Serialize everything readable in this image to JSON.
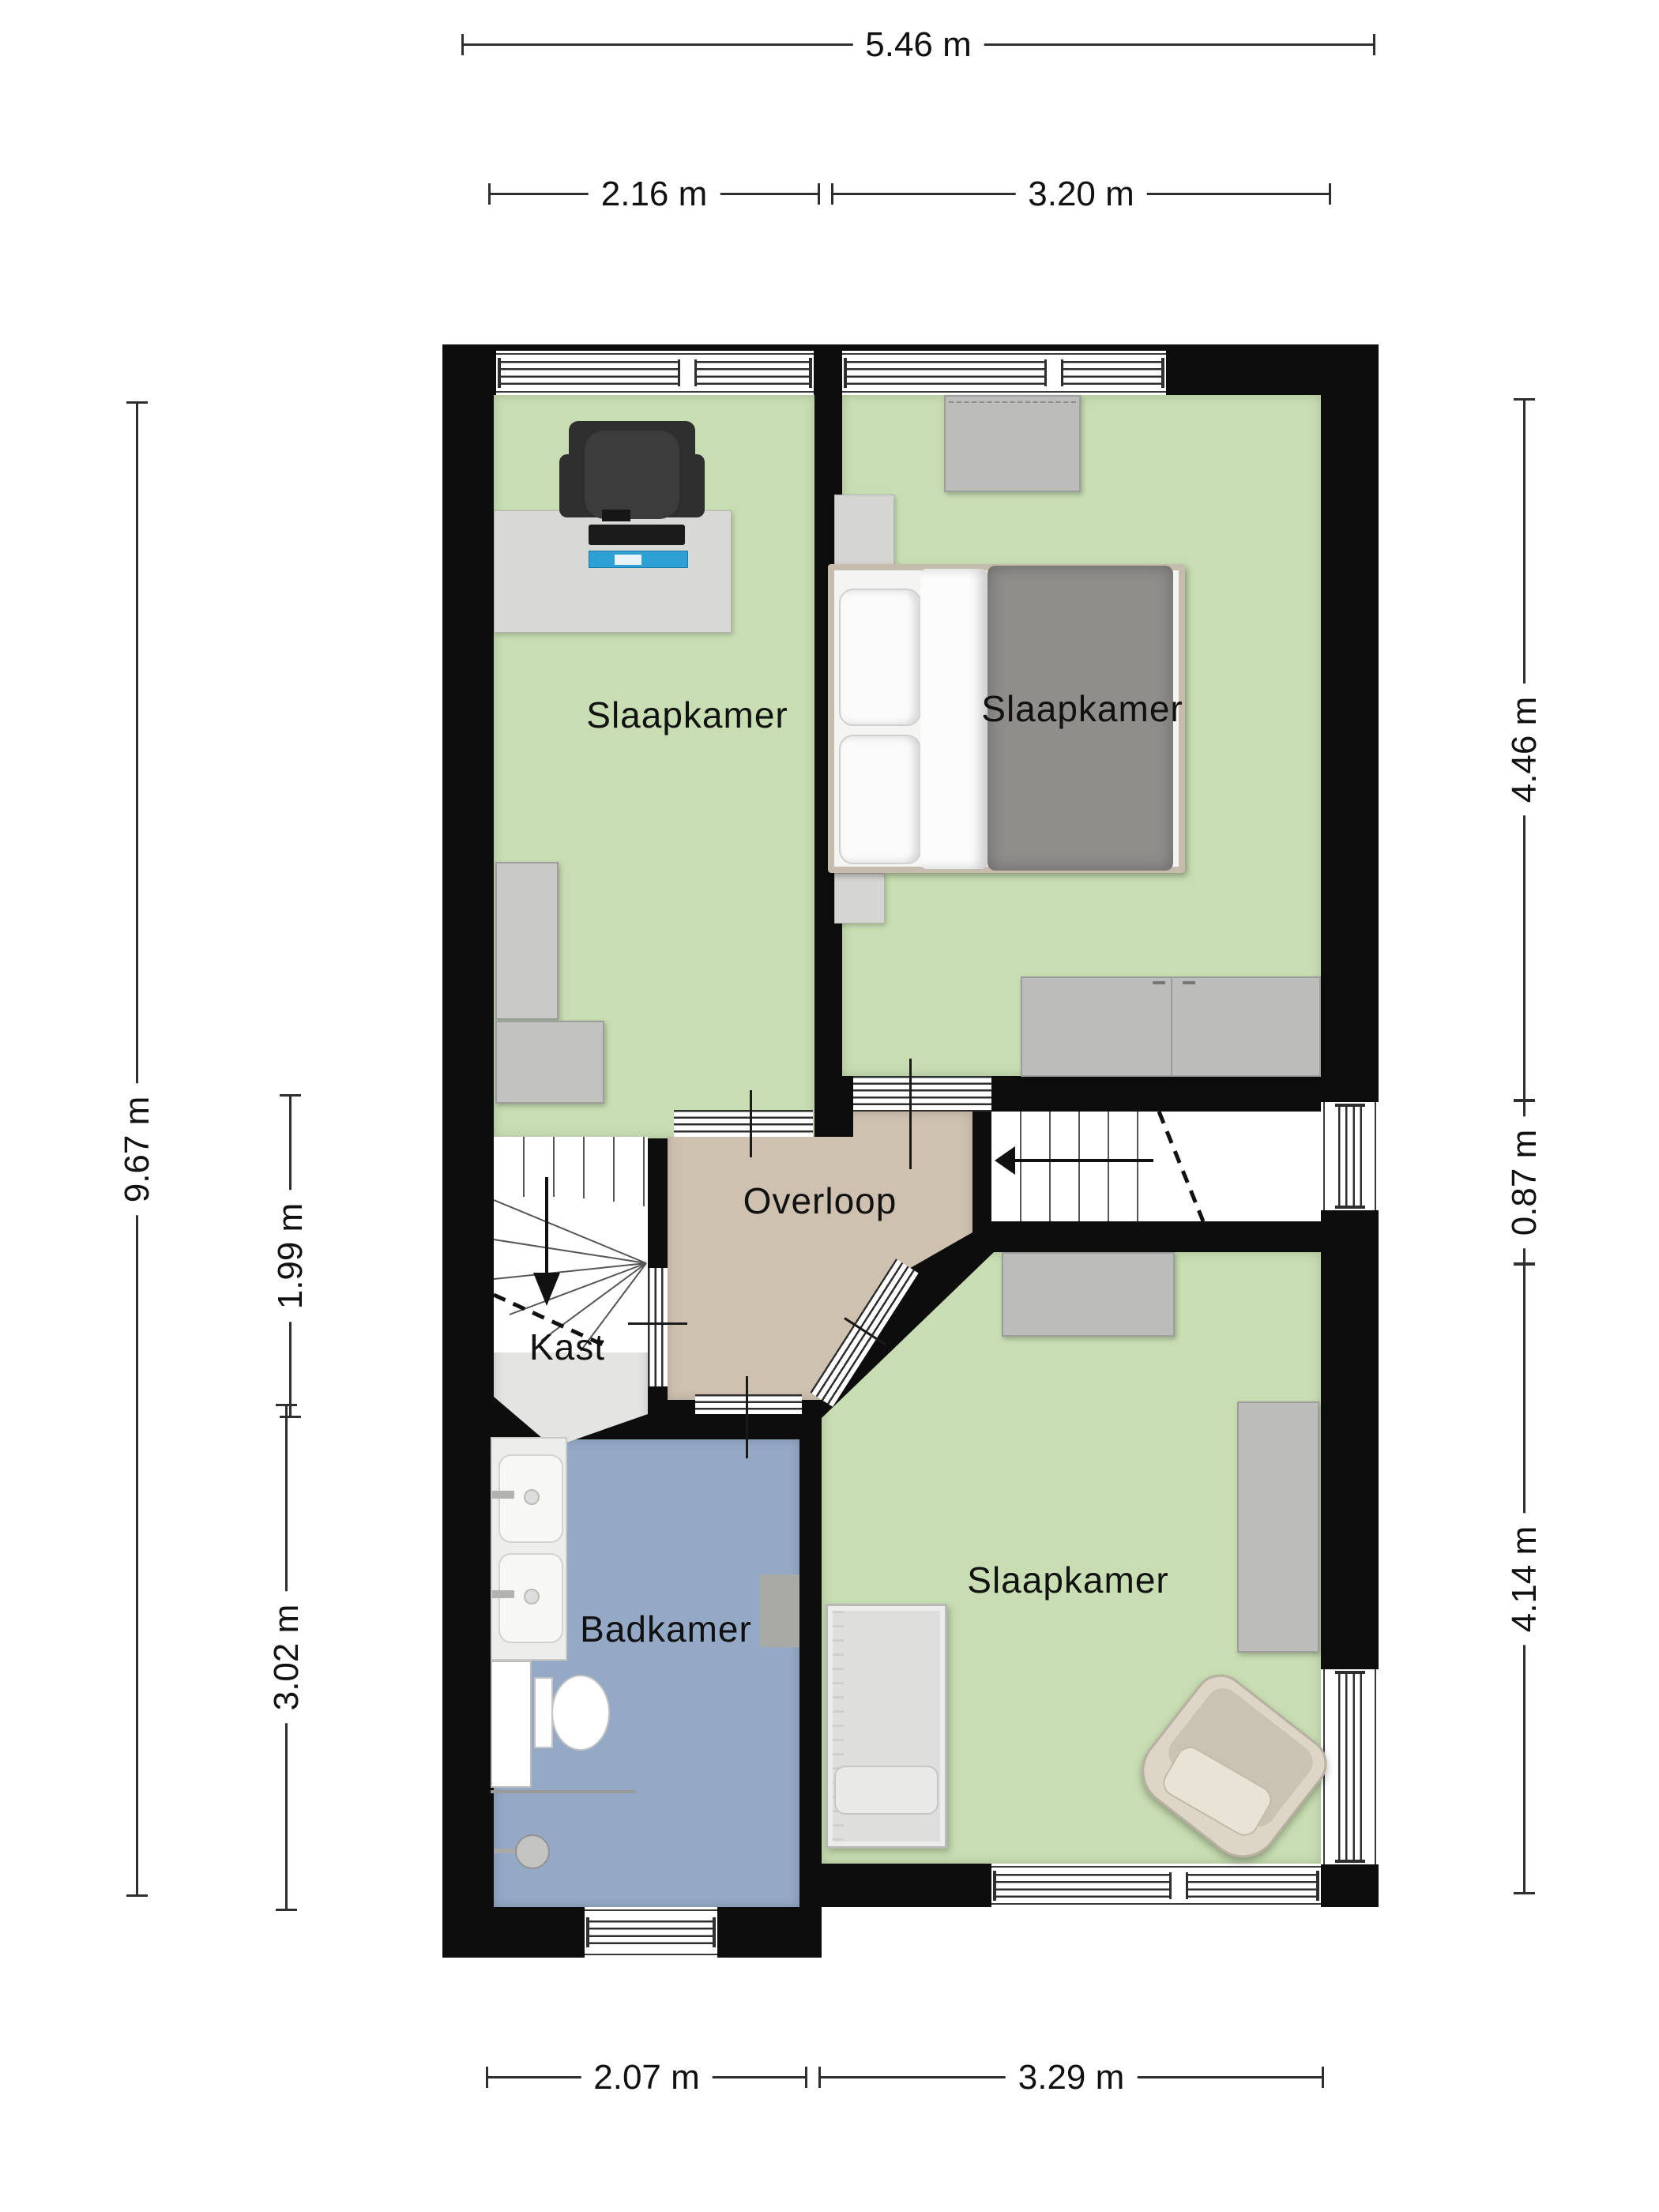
{
  "rooms": [
    {
      "id": "bedroom-top-left",
      "label": "Slaapkamer"
    },
    {
      "id": "bedroom-top-right",
      "label": "Slaapkamer"
    },
    {
      "id": "landing",
      "label": "Overloop"
    },
    {
      "id": "closet",
      "label": "Kast"
    },
    {
      "id": "bathroom",
      "label": "Badkamer"
    },
    {
      "id": "bedroom-bottom",
      "label": "Slaapkamer"
    }
  ],
  "dimensions": {
    "top_total": "5.46 m",
    "top_left": "2.16 m",
    "top_right": "3.20 m",
    "left_total": "9.67 m",
    "left_middle": "1.99 m",
    "left_bottom": "3.02 m",
    "right_top": "4.46 m",
    "right_middle": "0.87 m",
    "right_bottom": "4.14 m",
    "bottom_left": "2.07 m",
    "bottom_right": "3.29 m"
  },
  "colors": {
    "wall": "#0d0d0d",
    "bedroom_floor": "#c8deb2",
    "landing_floor": "#cec1b0",
    "bathroom_floor": "#93a9c6",
    "closet_floor": "#e4e4e2"
  }
}
